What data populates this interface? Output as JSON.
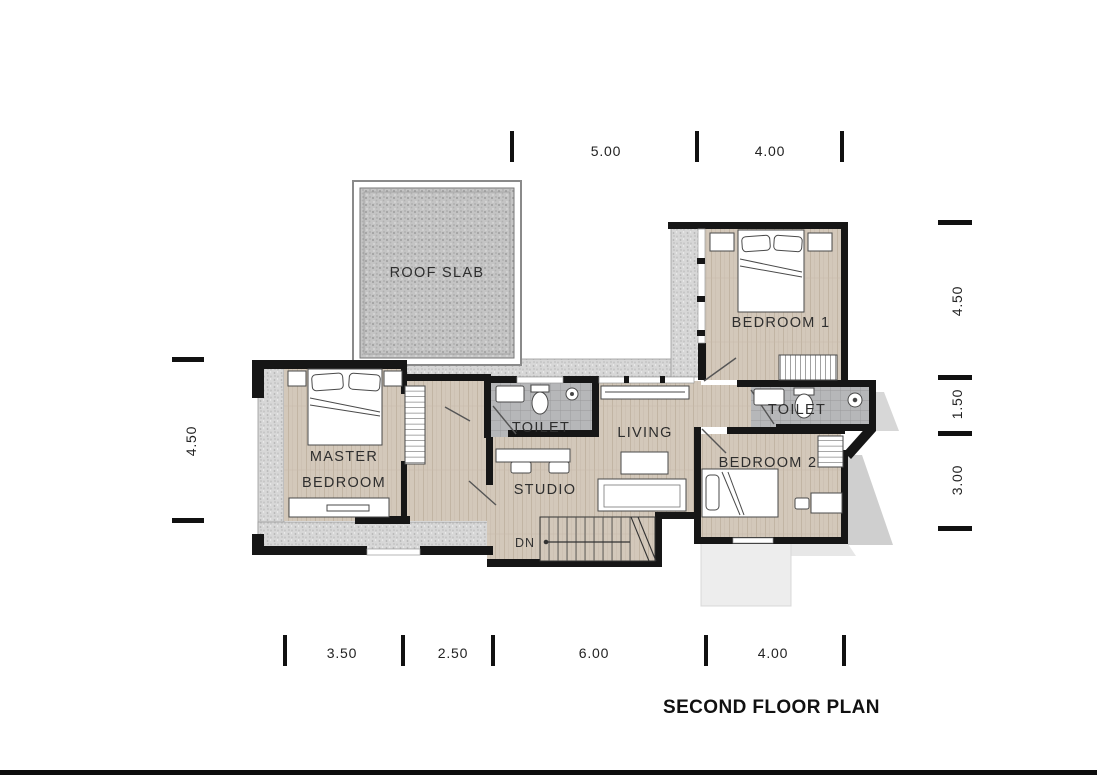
{
  "title": "SECOND FLOOR PLAN",
  "plan": {
    "labels": {
      "roof_slab": "ROOF SLAB",
      "bedroom1": "BEDROOM 1",
      "toilet_right": "TOILET",
      "toilet_left": "TOILET",
      "master_line1": "MASTER",
      "master_line2": "BEDROOM",
      "studio": "STUDIO",
      "living": "LIVING",
      "bedroom2": "BEDROOM 2",
      "stair_direction": "DN"
    },
    "dimensions": {
      "top": [
        "5.00",
        "4.00"
      ],
      "bottom": [
        "3.50",
        "2.50",
        "6.00",
        "4.00"
      ],
      "left": [
        "4.50"
      ],
      "right": [
        "4.50",
        "1.50",
        "3.00"
      ]
    },
    "colors": {
      "wall": "#161616",
      "wood_floor": "#d3c8ba",
      "tile_floor": "#b6b7b9",
      "gravel": "#d7d7d7",
      "label_text": "#2e2e2e"
    }
  }
}
